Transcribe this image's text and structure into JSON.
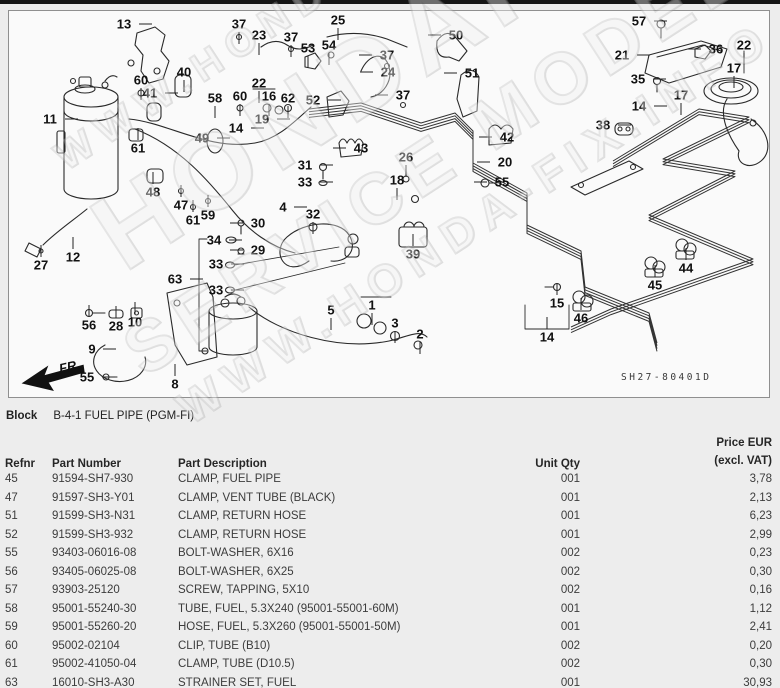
{
  "block": {
    "label": "Block",
    "value": "B-4-1 FUEL PIPE (PGM-FI)"
  },
  "diagram": {
    "code": "SH27-80401D",
    "fr_label": "FR.",
    "callouts": [
      {
        "n": "13",
        "x": 115,
        "y": 13,
        "d": "r"
      },
      {
        "n": "37",
        "x": 230,
        "y": 13,
        "d": "d"
      },
      {
        "n": "23",
        "x": 250,
        "y": 24,
        "d": "d"
      },
      {
        "n": "25",
        "x": 329,
        "y": 9,
        "d": "d"
      },
      {
        "n": "37",
        "x": 282,
        "y": 26,
        "d": "d"
      },
      {
        "n": "53",
        "x": 299,
        "y": 37,
        "d": "d"
      },
      {
        "n": "54",
        "x": 320,
        "y": 34,
        "d": "d"
      },
      {
        "n": "37",
        "x": 378,
        "y": 44,
        "d": "l"
      },
      {
        "n": "24",
        "x": 379,
        "y": 61,
        "d": "l"
      },
      {
        "n": "60",
        "x": 132,
        "y": 69,
        "d": "d"
      },
      {
        "n": "40",
        "x": 175,
        "y": 61,
        "d": "d"
      },
      {
        "n": "41",
        "x": 141,
        "y": 82,
        "d": "r"
      },
      {
        "n": "58",
        "x": 206,
        "y": 87,
        "d": "d"
      },
      {
        "n": "60",
        "x": 231,
        "y": 85,
        "d": "d"
      },
      {
        "n": "22",
        "x": 250,
        "y": 72,
        "d": "d"
      },
      {
        "n": "16",
        "x": 260,
        "y": 85,
        "d": "d"
      },
      {
        "n": "62",
        "x": 279,
        "y": 87,
        "d": "d"
      },
      {
        "n": "52",
        "x": 304,
        "y": 89,
        "d": "r"
      },
      {
        "n": "11",
        "x": 41,
        "y": 108,
        "d": "r"
      },
      {
        "n": "19",
        "x": 253,
        "y": 108,
        "d": "r"
      },
      {
        "n": "14",
        "x": 227,
        "y": 117,
        "d": "r"
      },
      {
        "n": "49",
        "x": 193,
        "y": 127,
        "d": "r"
      },
      {
        "n": "61",
        "x": 129,
        "y": 137,
        "d": "u"
      },
      {
        "n": "48",
        "x": 144,
        "y": 181,
        "d": "u"
      },
      {
        "n": "43",
        "x": 352,
        "y": 137,
        "d": "l"
      },
      {
        "n": "31",
        "x": 296,
        "y": 154,
        "d": "r"
      },
      {
        "n": "33",
        "x": 296,
        "y": 171,
        "d": "r"
      },
      {
        "n": "26",
        "x": 397,
        "y": 146,
        "d": "d"
      },
      {
        "n": "18",
        "x": 388,
        "y": 169,
        "d": "d"
      },
      {
        "n": "42",
        "x": 498,
        "y": 126,
        "d": "l"
      },
      {
        "n": "20",
        "x": 496,
        "y": 151,
        "d": "l"
      },
      {
        "n": "55",
        "x": 493,
        "y": 171,
        "d": "l"
      },
      {
        "n": "50",
        "x": 447,
        "y": 24,
        "d": "l"
      },
      {
        "n": "51",
        "x": 463,
        "y": 62,
        "d": "l"
      },
      {
        "n": "37",
        "x": 394,
        "y": 84,
        "d": "l"
      },
      {
        "n": "57",
        "x": 630,
        "y": 10,
        "d": "r"
      },
      {
        "n": "21",
        "x": 613,
        "y": 44,
        "d": "r"
      },
      {
        "n": "36",
        "x": 707,
        "y": 38,
        "d": "l"
      },
      {
        "n": "22",
        "x": 735,
        "y": 34,
        "d": "d"
      },
      {
        "n": "17",
        "x": 725,
        "y": 57,
        "d": "d"
      },
      {
        "n": "35",
        "x": 629,
        "y": 68,
        "d": "r"
      },
      {
        "n": "17",
        "x": 672,
        "y": 84,
        "d": "d"
      },
      {
        "n": "14",
        "x": 630,
        "y": 95,
        "d": "r"
      },
      {
        "n": "38",
        "x": 594,
        "y": 114,
        "d": "r"
      },
      {
        "n": "47",
        "x": 172,
        "y": 194,
        "d": "u"
      },
      {
        "n": "61",
        "x": 184,
        "y": 209,
        "d": "u"
      },
      {
        "n": "59",
        "x": 199,
        "y": 204,
        "d": "u"
      },
      {
        "n": "4",
        "x": 274,
        "y": 196,
        "d": "r"
      },
      {
        "n": "32",
        "x": 304,
        "y": 203,
        "d": "d"
      },
      {
        "n": "30",
        "x": 249,
        "y": 212,
        "d": "l"
      },
      {
        "n": "34",
        "x": 205,
        "y": 229,
        "d": "r"
      },
      {
        "n": "29",
        "x": 249,
        "y": 239,
        "d": "l"
      },
      {
        "n": "33",
        "x": 207,
        "y": 253,
        "d": "r"
      },
      {
        "n": "63",
        "x": 166,
        "y": 268,
        "d": "r"
      },
      {
        "n": "33",
        "x": 207,
        "y": 279,
        "d": "r"
      },
      {
        "n": "27",
        "x": 32,
        "y": 254,
        "d": "u"
      },
      {
        "n": "12",
        "x": 64,
        "y": 246,
        "d": "u"
      },
      {
        "n": "56",
        "x": 80,
        "y": 314,
        "d": "u"
      },
      {
        "n": "28",
        "x": 107,
        "y": 315,
        "d": "u"
      },
      {
        "n": "10",
        "x": 126,
        "y": 311,
        "d": "u"
      },
      {
        "n": "9",
        "x": 83,
        "y": 338,
        "d": "r"
      },
      {
        "n": "5",
        "x": 322,
        "y": 299,
        "d": "d"
      },
      {
        "n": "1",
        "x": 363,
        "y": 294,
        "d": "d"
      },
      {
        "n": "3",
        "x": 386,
        "y": 312,
        "d": "d"
      },
      {
        "n": "2",
        "x": 411,
        "y": 323,
        "d": "d"
      },
      {
        "n": "8",
        "x": 166,
        "y": 373,
        "d": "u"
      },
      {
        "n": "55",
        "x": 78,
        "y": 366,
        "d": "r"
      },
      {
        "n": "39",
        "x": 404,
        "y": 243,
        "d": "u"
      },
      {
        "n": "44",
        "x": 677,
        "y": 257,
        "d": "u"
      },
      {
        "n": "45",
        "x": 646,
        "y": 274,
        "d": "u"
      },
      {
        "n": "15",
        "x": 548,
        "y": 292,
        "d": "u"
      },
      {
        "n": "46",
        "x": 572,
        "y": 307,
        "d": "u"
      },
      {
        "n": "14",
        "x": 538,
        "y": 326,
        "d": "u"
      }
    ]
  },
  "watermark": {
    "lines": [
      {
        "text": "WWW.HONDA-FIX.INFO",
        "size": 40
      },
      {
        "text": "HONDAFIX",
        "size": 108
      },
      {
        "text": "SERVICE MODEL",
        "size": 72
      },
      {
        "text": "WWW.HONDA-FIX.INFO",
        "size": 46
      }
    ]
  },
  "table": {
    "columns": {
      "refnr": "Refnr",
      "part_number": "Part Number",
      "description": "Part Description",
      "unit_qty": "Unit Qty",
      "price_line1": "Price EUR",
      "price_line2": "(excl. VAT)"
    },
    "rows": [
      {
        "refnr": "45",
        "part_number": "91594-SH7-930",
        "description": "CLAMP, FUEL PIPE",
        "unit_qty": "001",
        "price": "3,78"
      },
      {
        "refnr": "47",
        "part_number": "91597-SH3-Y01",
        "description": "CLAMP, VENT TUBE (BLACK)",
        "unit_qty": "001",
        "price": "2,13"
      },
      {
        "refnr": "51",
        "part_number": "91599-SH3-N31",
        "description": "CLAMP, RETURN HOSE",
        "unit_qty": "001",
        "price": "6,23"
      },
      {
        "refnr": "52",
        "part_number": "91599-SH3-932",
        "description": "CLAMP, RETURN HOSE",
        "unit_qty": "001",
        "price": "2,99"
      },
      {
        "refnr": "55",
        "part_number": "93403-06016-08",
        "description": "BOLT-WASHER, 6X16",
        "unit_qty": "002",
        "price": "0,23"
      },
      {
        "refnr": "56",
        "part_number": "93405-06025-08",
        "description": "BOLT-WASHER, 6X25",
        "unit_qty": "002",
        "price": "0,30"
      },
      {
        "refnr": "57",
        "part_number": "93903-25120",
        "description": "SCREW, TAPPING, 5X10",
        "unit_qty": "002",
        "price": "0,16"
      },
      {
        "refnr": "58",
        "part_number": "95001-55240-30",
        "description": "TUBE, FUEL, 5.3X240 (95001-55001-60M)",
        "unit_qty": "001",
        "price": "1,12"
      },
      {
        "refnr": "59",
        "part_number": "95001-55260-20",
        "description": "HOSE, FUEL, 5.3X260 (95001-55001-50M)",
        "unit_qty": "001",
        "price": "2,41"
      },
      {
        "refnr": "60",
        "part_number": "95002-02104",
        "description": "CLIP, TUBE (B10)",
        "unit_qty": "002",
        "price": "0,20"
      },
      {
        "refnr": "61",
        "part_number": "95002-41050-04",
        "description": "CLAMP, TUBE (D10.5)",
        "unit_qty": "002",
        "price": "0,30"
      },
      {
        "refnr": "63",
        "part_number": "16010-SH3-A30",
        "description": "STRAINER SET, FUEL",
        "unit_qty": "001",
        "price": "30,93"
      }
    ]
  }
}
